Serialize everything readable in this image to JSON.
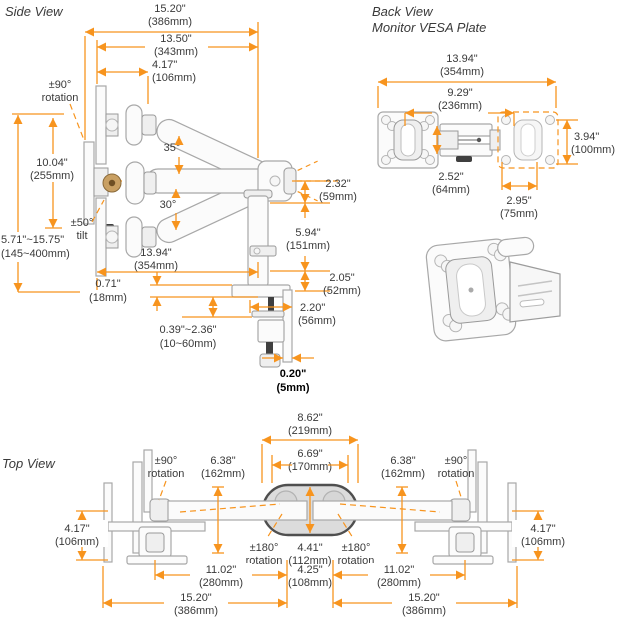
{
  "colors": {
    "accent": "#F7941E",
    "text": "#3A3A3A",
    "bold_text": "#000000",
    "structure_gray": "#A8A8A8"
  },
  "side": {
    "title": "Side View",
    "rot90": {
      "a": "±90°",
      "b": "rotation"
    },
    "tilt50": {
      "a": "±50°",
      "b": "tilt"
    },
    "a35": "35°",
    "a30": "30°",
    "d1520": {
      "in": "15.20\"",
      "mm": "(386mm)"
    },
    "d1350": {
      "in": "13.50\"",
      "mm": "(343mm)"
    },
    "d417": {
      "in": "4.17\"",
      "mm": "(106mm)"
    },
    "d1004": {
      "in": "10.04\"",
      "mm": "(255mm)"
    },
    "range": {
      "in": "5.71\"~15.75\"",
      "mm": "(145~400mm)"
    },
    "d232": {
      "in": "2.32\"",
      "mm": "(59mm)"
    },
    "d594": {
      "in": "5.94\"",
      "mm": "(151mm)"
    },
    "d205": {
      "in": "2.05\"",
      "mm": "(52mm)"
    },
    "d220": {
      "in": "2.20\"",
      "mm": "(56mm)"
    },
    "d1394": {
      "in": "13.94\"",
      "mm": "(354mm)"
    },
    "d071": {
      "in": "0.71\"",
      "mm": "(18mm)"
    },
    "clamp_range": {
      "in": "0.39\"~2.36\"",
      "mm": "(10~60mm)"
    },
    "d020": {
      "in": "0.20\"",
      "mm": "(5mm)"
    }
  },
  "back": {
    "title_line1": "Back View",
    "title_line2": "Monitor VESA Plate",
    "d1394": {
      "in": "13.94\"",
      "mm": "(354mm)"
    },
    "d929": {
      "in": "9.29\"",
      "mm": "(236mm)"
    },
    "d394": {
      "in": "3.94\"",
      "mm": "(100mm)"
    },
    "d252": {
      "in": "2.52\"",
      "mm": "(64mm)"
    },
    "d295": {
      "in": "2.95\"",
      "mm": "(75mm)"
    }
  },
  "top": {
    "title": "Top View",
    "d862": {
      "in": "8.62\"",
      "mm": "(219mm)"
    },
    "d669": {
      "in": "6.69\"",
      "mm": "(170mm)"
    },
    "rot90_left": {
      "a": "±90°",
      "b": "rotation"
    },
    "rot90_right": {
      "a": "±90°",
      "b": "rotation"
    },
    "d638_left": {
      "in": "6.38\"",
      "mm": "(162mm)"
    },
    "d638_right": {
      "in": "6.38\"",
      "mm": "(162mm)"
    },
    "d417_left": {
      "in": "4.17\"",
      "mm": "(106mm)"
    },
    "d417_right": {
      "in": "4.17\"",
      "mm": "(106mm)"
    },
    "rot180_left": {
      "a": "±180°",
      "b": "rotation"
    },
    "rot180_right": {
      "a": "±180°",
      "b": "rotation"
    },
    "d441": {
      "in": "4.41\"",
      "mm": "(112mm)"
    },
    "d1102_left": {
      "in": "11.02\"",
      "mm": "(280mm)"
    },
    "d1102_right": {
      "in": "11.02\"",
      "mm": "(280mm)"
    },
    "d425": {
      "in": "4.25\"",
      "mm": "(108mm)"
    },
    "d1520_left": {
      "in": "15.20\"",
      "mm": "(386mm)"
    },
    "d1520_right": {
      "in": "15.20\"",
      "mm": "(386mm)"
    }
  }
}
